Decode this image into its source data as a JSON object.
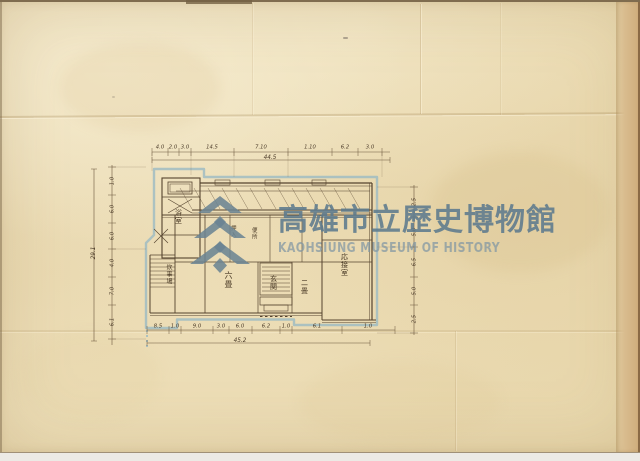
{
  "document": {
    "kind": "scanned historical architectural floor plan",
    "paper_color": "#ecdebb",
    "edge_band_color": "#d9bc8e"
  },
  "watermark": {
    "logo": "kaohsiung-museum-emblem",
    "cjk": "高雄市立歷史博物館",
    "latin": "KAOHSIUNG MUSEUM OF HISTORY",
    "color": "#6e8a9b"
  },
  "plan": {
    "outline_color_blue": "#9bbac3",
    "ink_color": "#55432e",
    "rooms": {
      "bath": "浴室",
      "kitchen": "炊事場",
      "six_mat": "六畳",
      "entrance": "玄関",
      "two_mat": "二畳",
      "reception": "応接室",
      "closet": "押入",
      "toilet": "便所"
    },
    "dims": {
      "top": [
        "4.0",
        "2.0",
        "3.0",
        "14.5",
        "7.10",
        "1.10",
        "6.2",
        "3.0"
      ],
      "top_total": "44.5",
      "bottom": [
        "8.5",
        "1.0",
        "9.0",
        "3.0",
        "6.0",
        "6.2",
        "1.0",
        "6.1",
        "1.0"
      ],
      "bottom_total": "45.2",
      "left": [
        "1.0",
        "6.0",
        "6.0",
        "4.0",
        "7.0",
        "6.1"
      ],
      "left_total": "29.1",
      "right": [
        "2.5",
        "5.0",
        "6.5",
        "5.0",
        "2.5"
      ]
    }
  }
}
